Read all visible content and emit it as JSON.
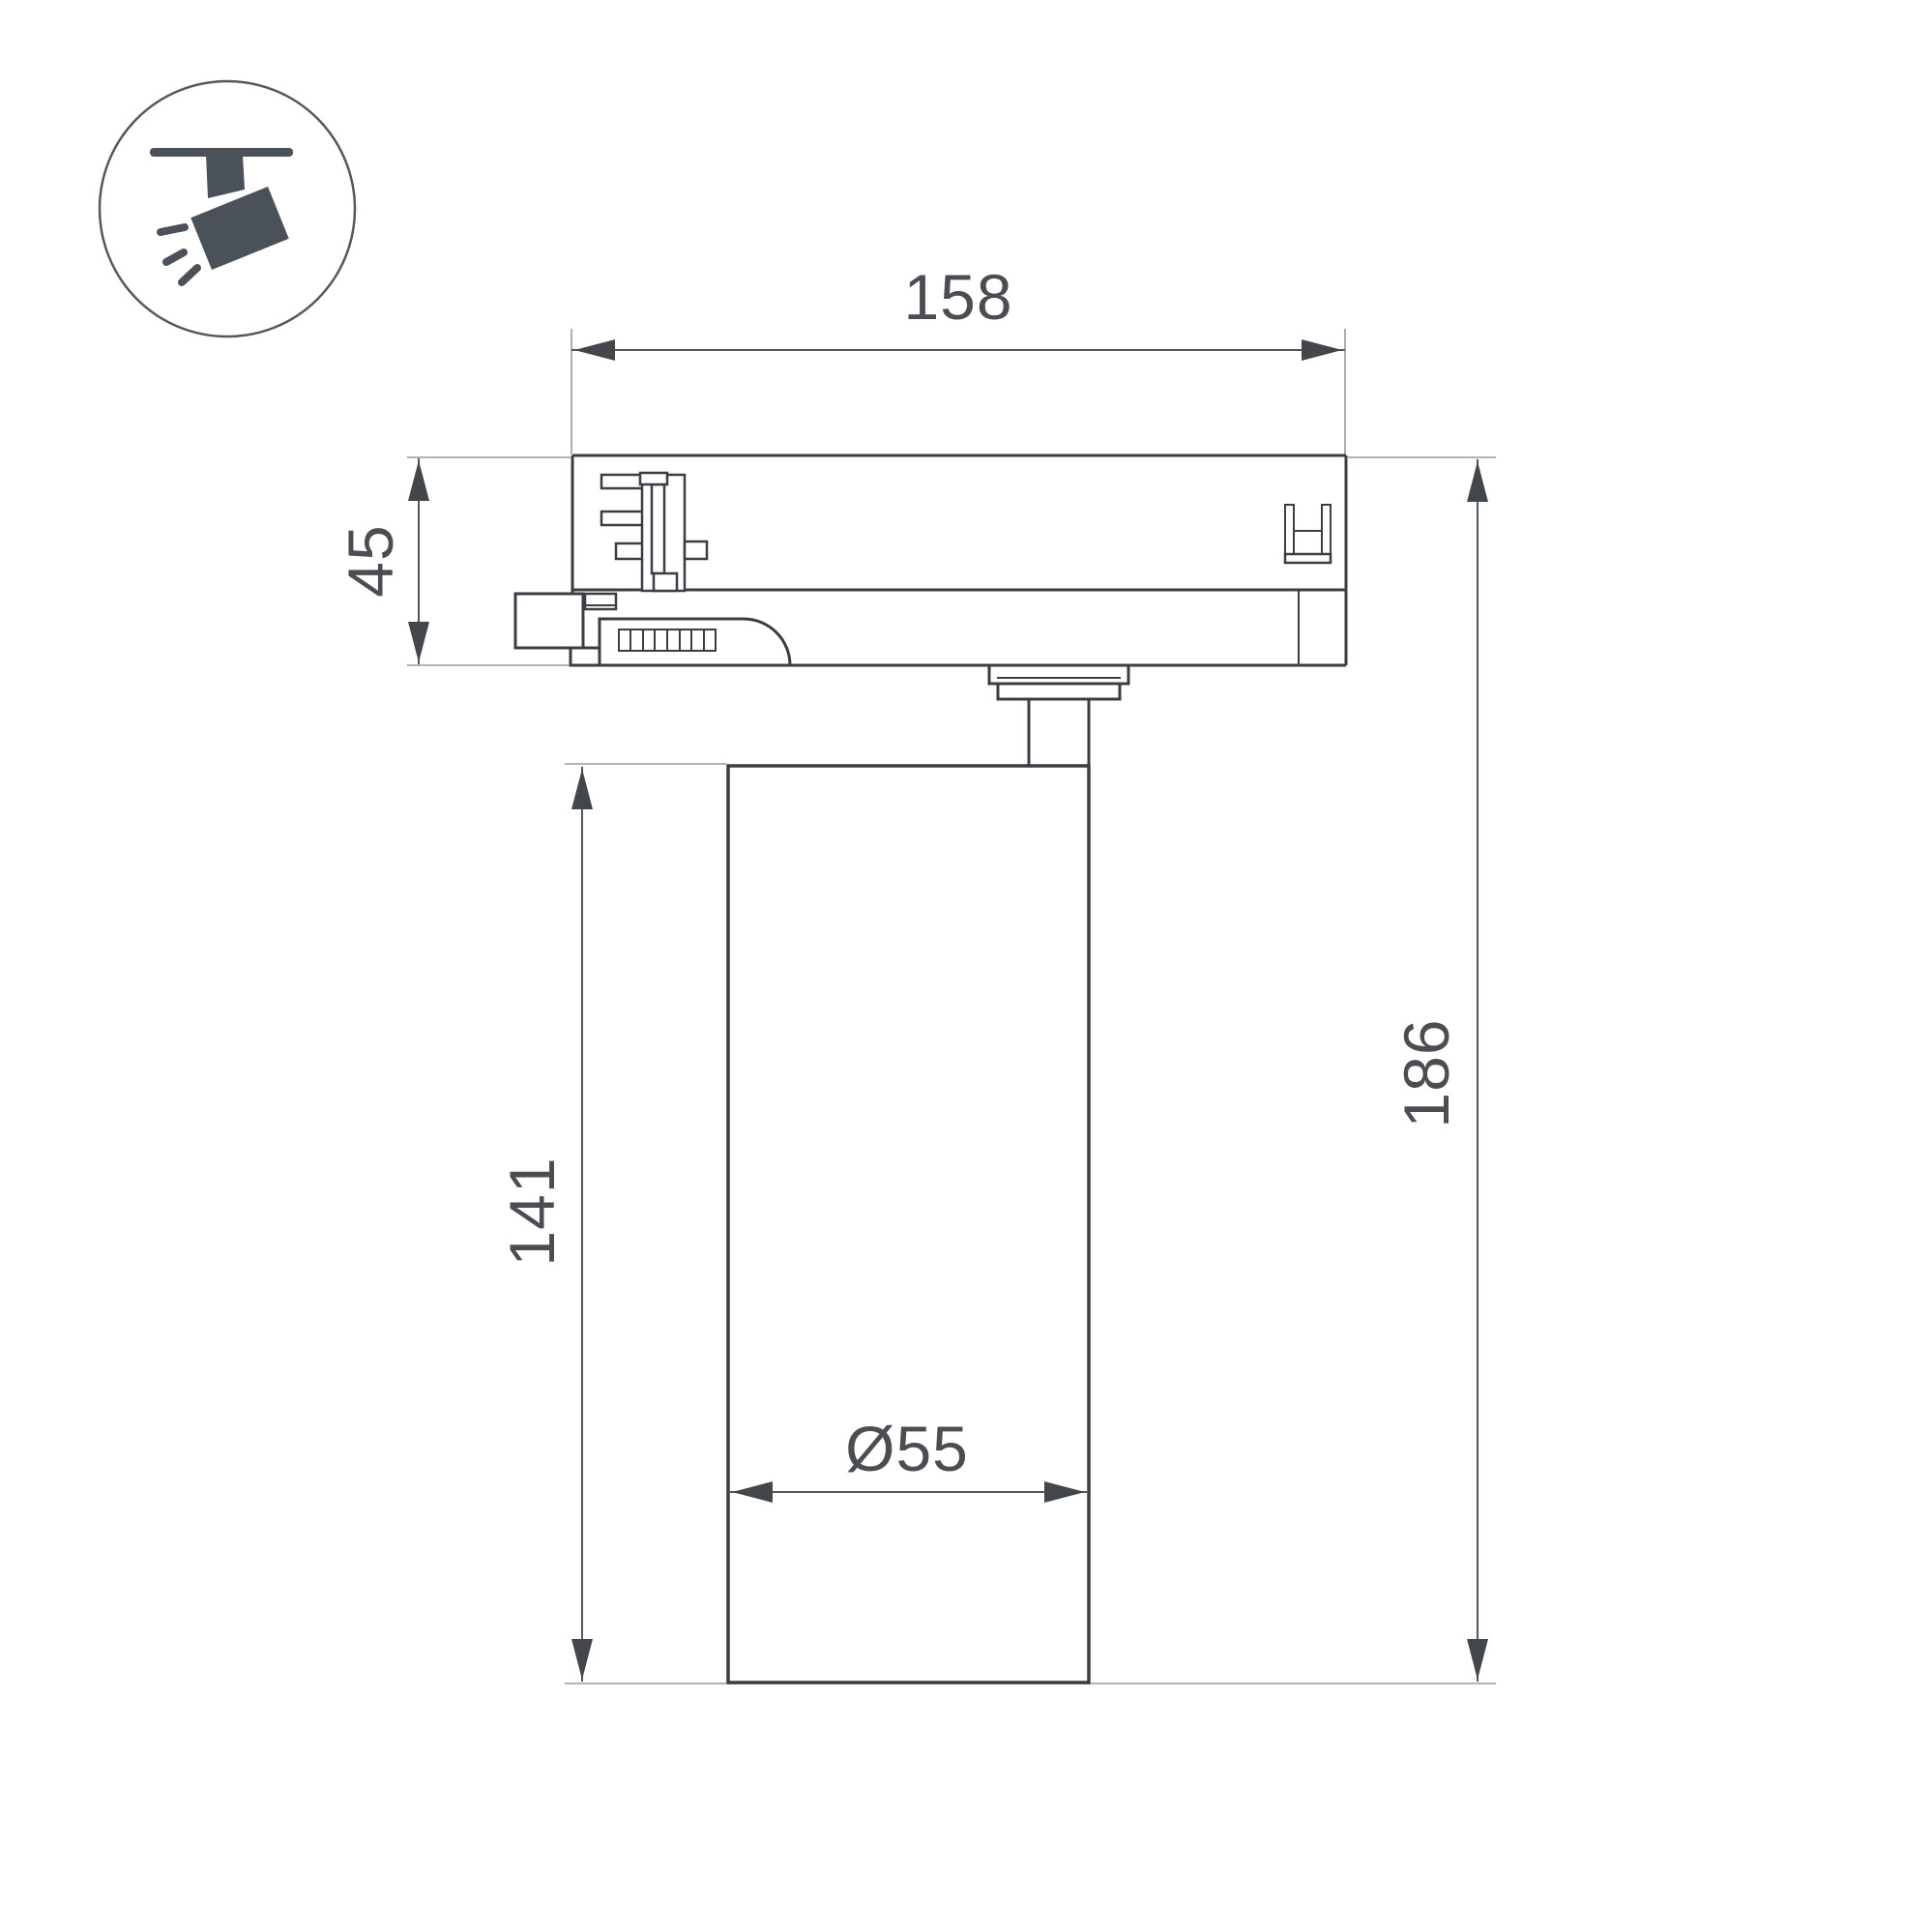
{
  "document": {
    "title": "Track spotlight dimensional drawing",
    "background": "#ffffff",
    "line_color": "#3a3e44",
    "dimension_line_color": "#53575b",
    "extension_line_color": "#97999c",
    "label_color": "#4a4e53",
    "icon_color": "#4a5158"
  },
  "icon": {
    "name": "ceiling-track-spotlight-pictogram"
  },
  "dimensions": {
    "adapter_width": {
      "value": "158"
    },
    "adapter_height": {
      "value": "45"
    },
    "body_height": {
      "value": "141"
    },
    "total_height": {
      "value": "186"
    },
    "body_diameter": {
      "value": "Ø55"
    }
  }
}
